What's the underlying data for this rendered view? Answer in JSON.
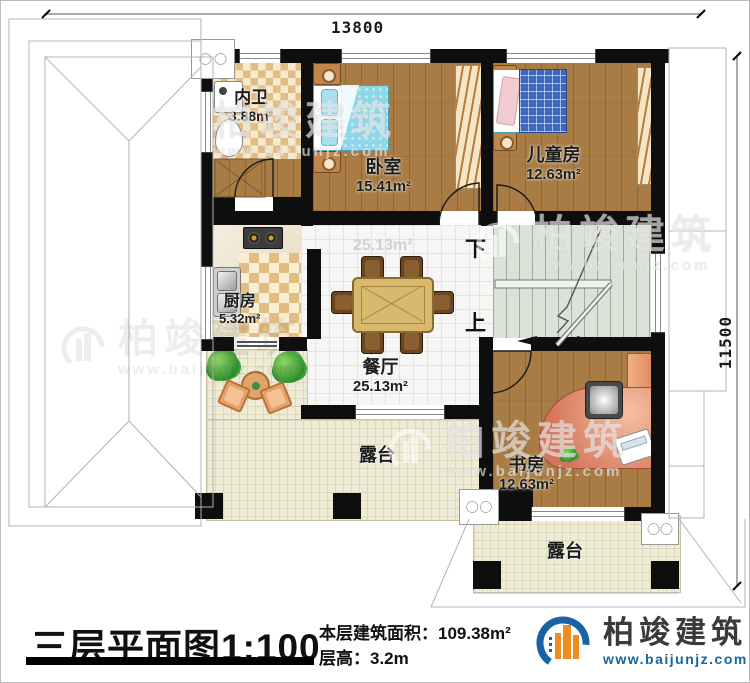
{
  "dimensions": {
    "width_label": "13800",
    "height_label": "11500"
  },
  "rooms": {
    "bathroom": {
      "name": "内卫",
      "area": "3.88m²"
    },
    "bedroom": {
      "name": "卧室",
      "area": "15.41m²"
    },
    "kids_room": {
      "name": "儿童房",
      "area": "12.63m²"
    },
    "kitchen": {
      "name": "厨房",
      "area": "5.32m²"
    },
    "dining": {
      "name": "餐厅",
      "area": "25.13m²",
      "ghost_area": "25.13m²"
    },
    "study": {
      "name": "书房",
      "area": "12.63m²"
    },
    "terrace_left": {
      "name": "露台"
    },
    "terrace_right": {
      "name": "露台"
    }
  },
  "stairs": {
    "down_label": "下",
    "up_label": "上"
  },
  "title_block": {
    "title": "三层平面图",
    "scale": "1:100",
    "floor_area_label": "本层建筑面积：",
    "floor_area_value": "109.38m²",
    "floor_height_label": "层高：",
    "floor_height_value": "3.2m"
  },
  "brand": {
    "name": "柏竣建筑",
    "website": "www.baijunjz.com"
  },
  "watermark": {
    "name": "柏竣建筑",
    "website": "www.baijunjz.com"
  },
  "colors": {
    "wall": "#0e0e0e",
    "wood": "#a87c44",
    "tile": "#f6f6f4",
    "terrace": "#eeebd7",
    "checker": "#e2bd83",
    "stairs": "#dce2d8",
    "bed_blue": "#8fd6e8",
    "kids_blue": "#3f68b8",
    "desk_salmon": "#d5765a",
    "brand_blue": "#17649f",
    "brand_orange": "#f08c1e"
  }
}
